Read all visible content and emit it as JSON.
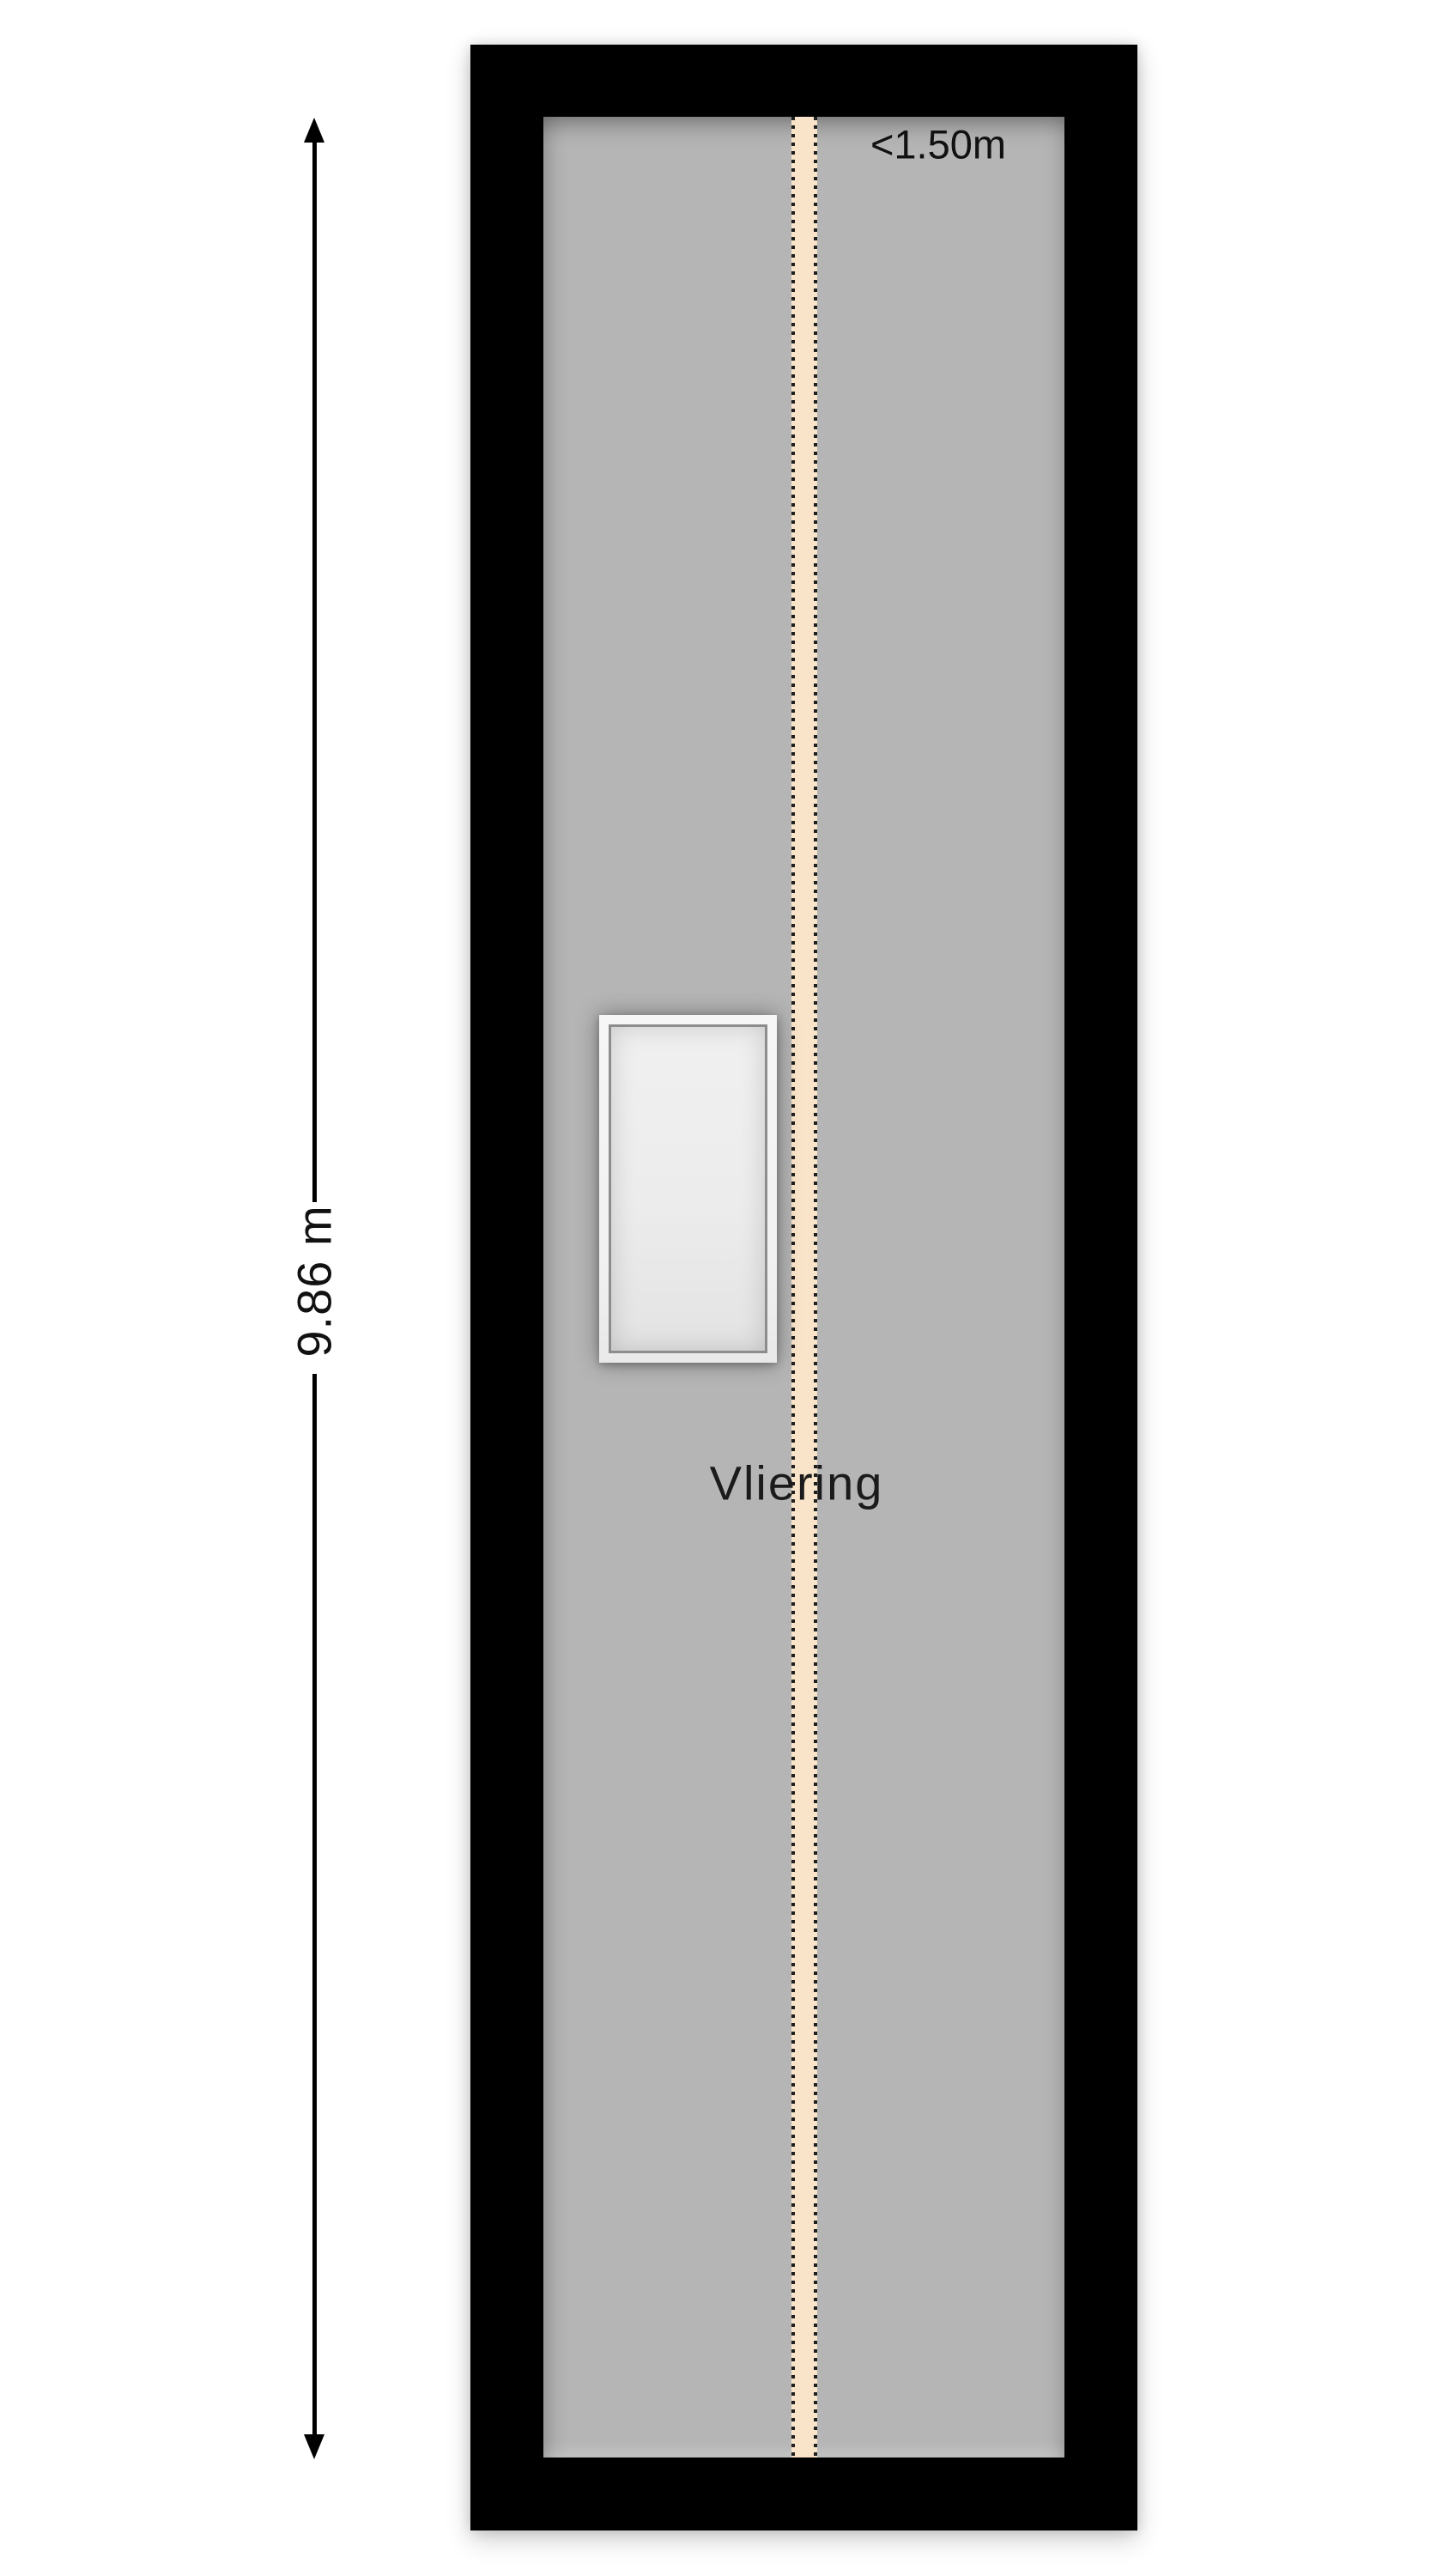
{
  "floorplan": {
    "room_label": "Vliering",
    "height_dimension": "9.86 m",
    "headroom_label": "<1.50m",
    "colors": {
      "background": "#ffffff",
      "wall": "#000000",
      "floor": "#b5b5b5",
      "headroom_band": "#f9e4c9",
      "headroom_dots": "#1f1f1f",
      "hatch_frame": "#f2f2f2",
      "hatch_interior": "#ececec",
      "text": "#1b1b1b"
    }
  }
}
